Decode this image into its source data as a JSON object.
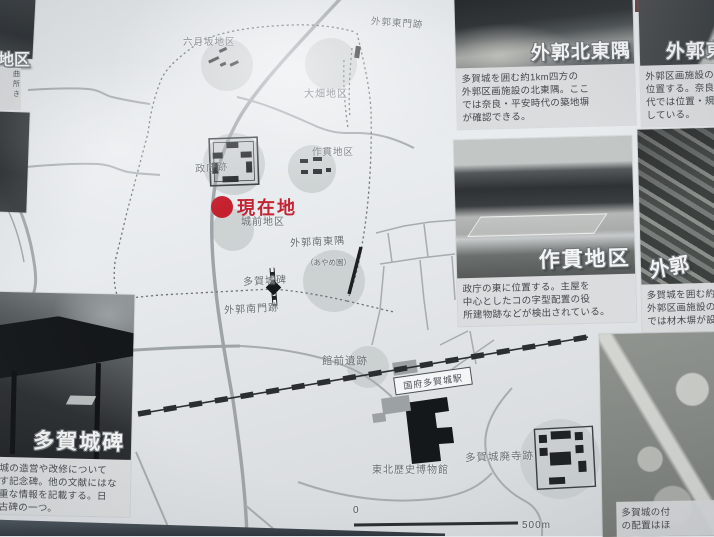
{
  "colors": {
    "accent_red": "#c22433",
    "sign_background": "#e3e7ea",
    "district_circle": "#c7cccd",
    "road_gray": "#a6abae",
    "label_gray": "#666d72",
    "railway_black": "#2b2e31",
    "caption_background": "#dadcdd",
    "caption_text": "#45494c"
  },
  "map": {
    "current_location_label": "現在地",
    "places": [
      {
        "label": "六月坂地区"
      },
      {
        "label": "大畑地区"
      },
      {
        "label": "外郭東門跡"
      },
      {
        "label": "政庁跡"
      },
      {
        "label": "作貫地区"
      },
      {
        "label": "城前地区"
      },
      {
        "label": "外郭南東隅"
      },
      {
        "label": "（あやめ園）"
      },
      {
        "label": "多賀城碑"
      },
      {
        "label": "外郭南門跡"
      },
      {
        "label": "館前遺跡"
      },
      {
        "label": "東北歴史博物館"
      },
      {
        "label": "多賀城廃寺跡"
      }
    ],
    "station_label": "国府多賀城駅",
    "scale_bar": {
      "zero": "0",
      "end": "500m"
    }
  },
  "panels": {
    "fragment_top_left": {
      "title": "地区",
      "caption_chars": [
        "曲",
        "所",
        "き"
      ]
    },
    "tagajo_hi": {
      "title": "多賀城碑",
      "lines": [
        "城の造営や改修について",
        "す記念碑。他の文献にはな",
        "重な情報を記載する。日",
        "古碑の一つ。"
      ]
    },
    "gaikaku_hokutougu": {
      "title": "外郭北東隅",
      "lines": [
        "多賀城を囲む約1km四方の",
        "外郭区画施設の北東隅。ここ",
        "では奈良・平安時代の築地塀",
        "が確認できる。"
      ]
    },
    "gaikaku_higashi": {
      "title": "外郭東",
      "lines": [
        "外郭区画施設の東",
        "位置する。奈良時",
        "代では位置・規模",
        "している。"
      ]
    },
    "sakkan": {
      "title": "作貫地区",
      "lines": [
        "政庁の東に位置する。主屋を",
        "中心としたコの字型配置の役",
        "所建物跡などが検出されている。"
      ]
    },
    "gaikaku_zai": {
      "title": "外郭",
      "lines": [
        "多賀城を囲む約",
        "外郭区画施設の",
        "では材木塀が設置"
      ]
    },
    "aerial": {
      "lines": [
        "多賀城の付",
        "の配置はほ"
      ]
    }
  }
}
